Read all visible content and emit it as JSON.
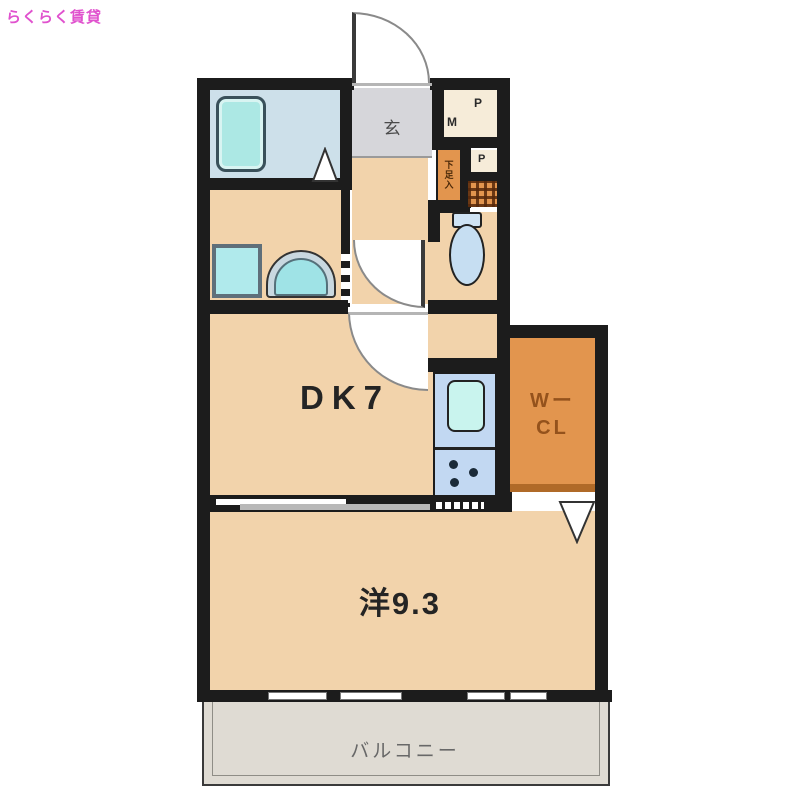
{
  "page": {
    "watermark": "らくらく賃貸"
  },
  "colors": {
    "wall": "#1c1c1c",
    "floor_beige": "#f2d3ab",
    "closet_orange": "#e2954e",
    "genkan_gray": "#d6d6da",
    "bath_blue": "#cde0ea",
    "fixture_cyan": "#ace8e6",
    "kitchen_blue": "#c2d8f2",
    "balcony_gray": "#dfdbd3",
    "watermark_pink": "#e052ce",
    "wcl_text_brown": "#94521c"
  },
  "labels": {
    "genkan": "玄",
    "dining_kitchen": "DK7",
    "western_room": "洋9.3",
    "walk_in_closet_line1": "Wー",
    "walk_in_closet_line2": "CL",
    "balcony": "バルコニー",
    "shoe_cabinet": "下足入",
    "meter_p": "P",
    "meter_m": "M",
    "pipe_p": "P"
  }
}
